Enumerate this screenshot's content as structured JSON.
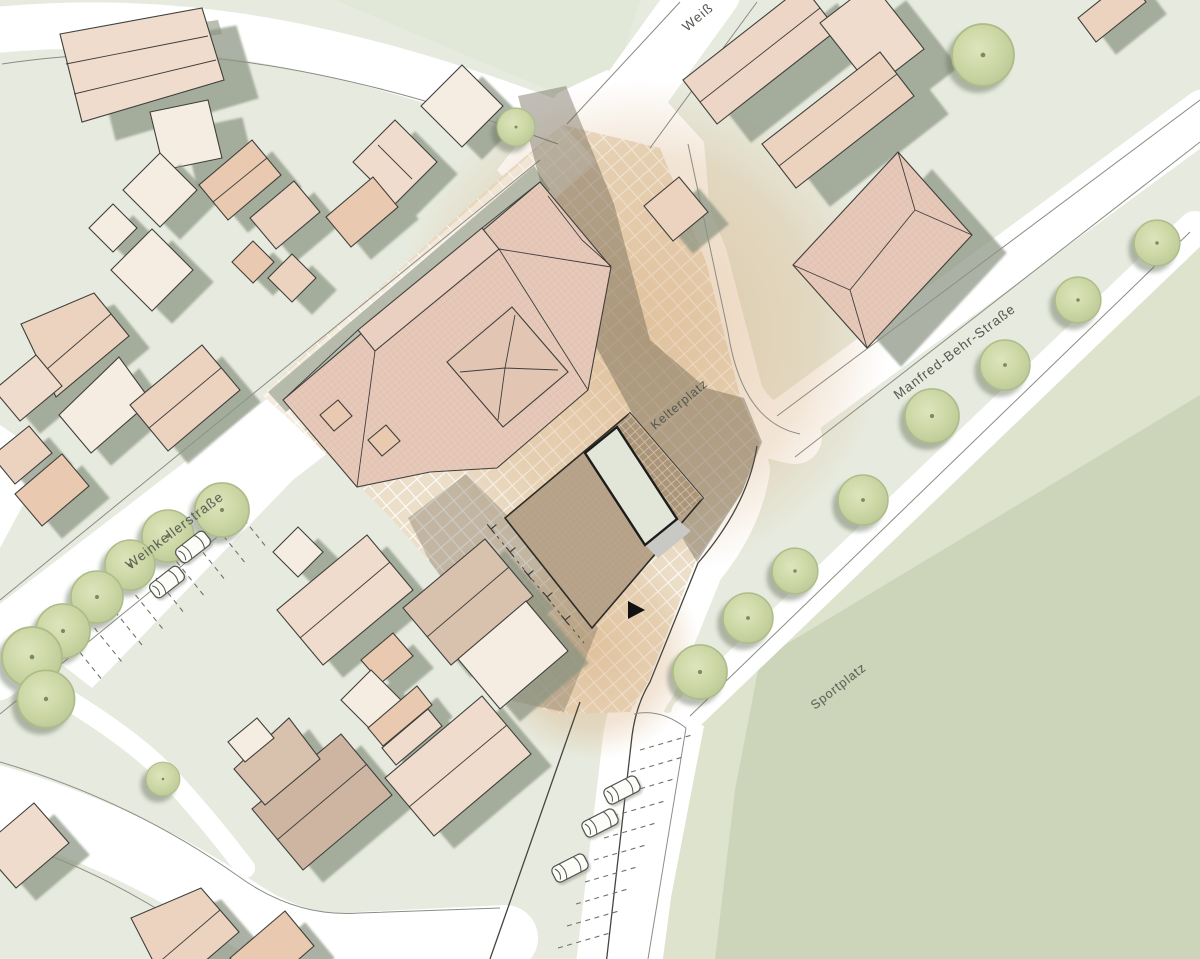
{
  "map": {
    "kind": "architectural site plan (Lageplan)",
    "labels": {
      "street_left": "Weinkellerstraße",
      "street_top_partial": "Weiß",
      "street_right": "Manfred-Behr-Straße",
      "plaza": "Kelterplatz",
      "sports_field": "Sportplatz"
    },
    "features": {
      "trees_left_row": 7,
      "trees_right_row": 8,
      "trees_single": 3,
      "cars_left_parking": 2,
      "cars_bottom_parking": 3,
      "parking_stalls_left": 9,
      "parking_stalls_bottom": 10,
      "entrance_marker": "black-triangle"
    },
    "colors": {
      "background": "#e7ebdf",
      "blockTint": "#dfe6d4",
      "road": "#ffffff",
      "roadEdge": "#8b8b84",
      "outline": "#3f3f3c",
      "roofPeach": "#ecd3c0",
      "roofPeachLight": "#f0dccc",
      "roofCream": "#f5ede2",
      "roofSalmon": "#e9c9b0",
      "roofDusty": "#d8c2ae",
      "roofBrown": "#cdb5a2",
      "roofKelter": "#e6c9b9",
      "roofPink": "#eed6c6",
      "newRoof": "#b7a48a",
      "skylight": "#e2e6d8",
      "greyRoof": "#c8c8c4",
      "pergola": "#c9ab87",
      "plazaTile": "#ecdfca",
      "plazaWarm": "#d9b88f",
      "shadow": "#a9b1a2",
      "tree": "#cdd8a6",
      "treeEdge": "#aebc8a",
      "field": "#ccd5b9",
      "fieldMargin": "#dde3cd",
      "label": "#55574f",
      "marker": "#111111"
    }
  }
}
